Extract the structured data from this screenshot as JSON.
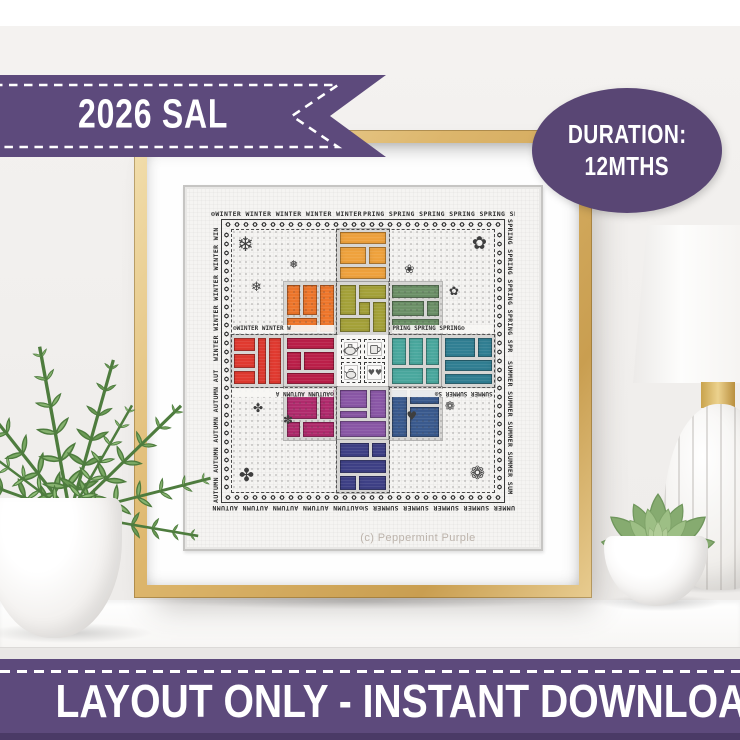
{
  "ribbon": {
    "label": "2026 SAL"
  },
  "badge": {
    "line1": "DURATION:",
    "line2": "12MTHS"
  },
  "bottom_banner": {
    "label": "LAYOUT ONLY - INSTANT DOWNLOAD"
  },
  "colors": {
    "banner_purple": "#5d4a7c",
    "banner_purple_dark": "#4a3a66",
    "badge_purple": "#594674",
    "frame_gold": "#d9b368",
    "wall": "#f3f1ef",
    "fabric": "#f5f4f2",
    "ink": "#333333",
    "caption_gray": "#bcb3ab"
  },
  "sampler": {
    "caption": "(c) Peppermint Purple",
    "border_words": {
      "top_left": "⊙WINTER WINTER WINTER WINTER WINTER WIN",
      "top_right": "PRING SPRING SPRING SPRING SPRING SPRING⊙",
      "bottom_summer": "UMMER SUMMER SUMMER SUMMER SUMMER SUM⊙",
      "bottom_autumn": "⊙AUTUMN AUTUMN AUTUMN AUTUMN AUTUMN AUT",
      "left_top_winter": "WINTER WINTER WINTER WINTER WIN",
      "left_bottom_autumn": "AUTUMN AUTUMN AUTUMN AUTUMN AUT",
      "right_top_spring": "SPRING SPRING SPRING SPRING SPR",
      "right_bottom_summer": "SUMMER SUMMER SUMMER SUMMER SUM",
      "inner_top_left": "⊙WINTER WINTER W",
      "inner_top_right": "PRING SPRING SPRING⊙",
      "inner_bottom_left": "⊙AUTUMN AUTUMN A",
      "inner_bottom_right": "SUMMER SUMMER S⊙"
    },
    "motif_icons": {
      "winter_snowflake": "❄",
      "winter_snowflake_alt": "❅",
      "spring_flower": "✿",
      "spring_flower_alt": "❀",
      "summer_flower": "❁",
      "summer_heart": "♥",
      "autumn_leaf": "✤",
      "autumn_leaf_alt": "✽",
      "hearts_pair": "♥♥"
    },
    "blocks": [
      {
        "name": "amber",
        "color": "#efa23d"
      },
      {
        "name": "orange",
        "color": "#ee762b"
      },
      {
        "name": "olive",
        "color": "#a4a139"
      },
      {
        "name": "sage",
        "color": "#6d9168"
      },
      {
        "name": "red",
        "color": "#e13a30"
      },
      {
        "name": "crimson",
        "color": "#bb1f49"
      },
      {
        "name": "teal-light",
        "color": "#4aa89e"
      },
      {
        "name": "teal-dark",
        "color": "#317f93"
      },
      {
        "name": "berry",
        "color": "#b02a6c"
      },
      {
        "name": "purple",
        "color": "#8a57a6"
      },
      {
        "name": "slate-blue",
        "color": "#3a5a8e"
      },
      {
        "name": "indigo",
        "color": "#3e4086"
      }
    ]
  }
}
